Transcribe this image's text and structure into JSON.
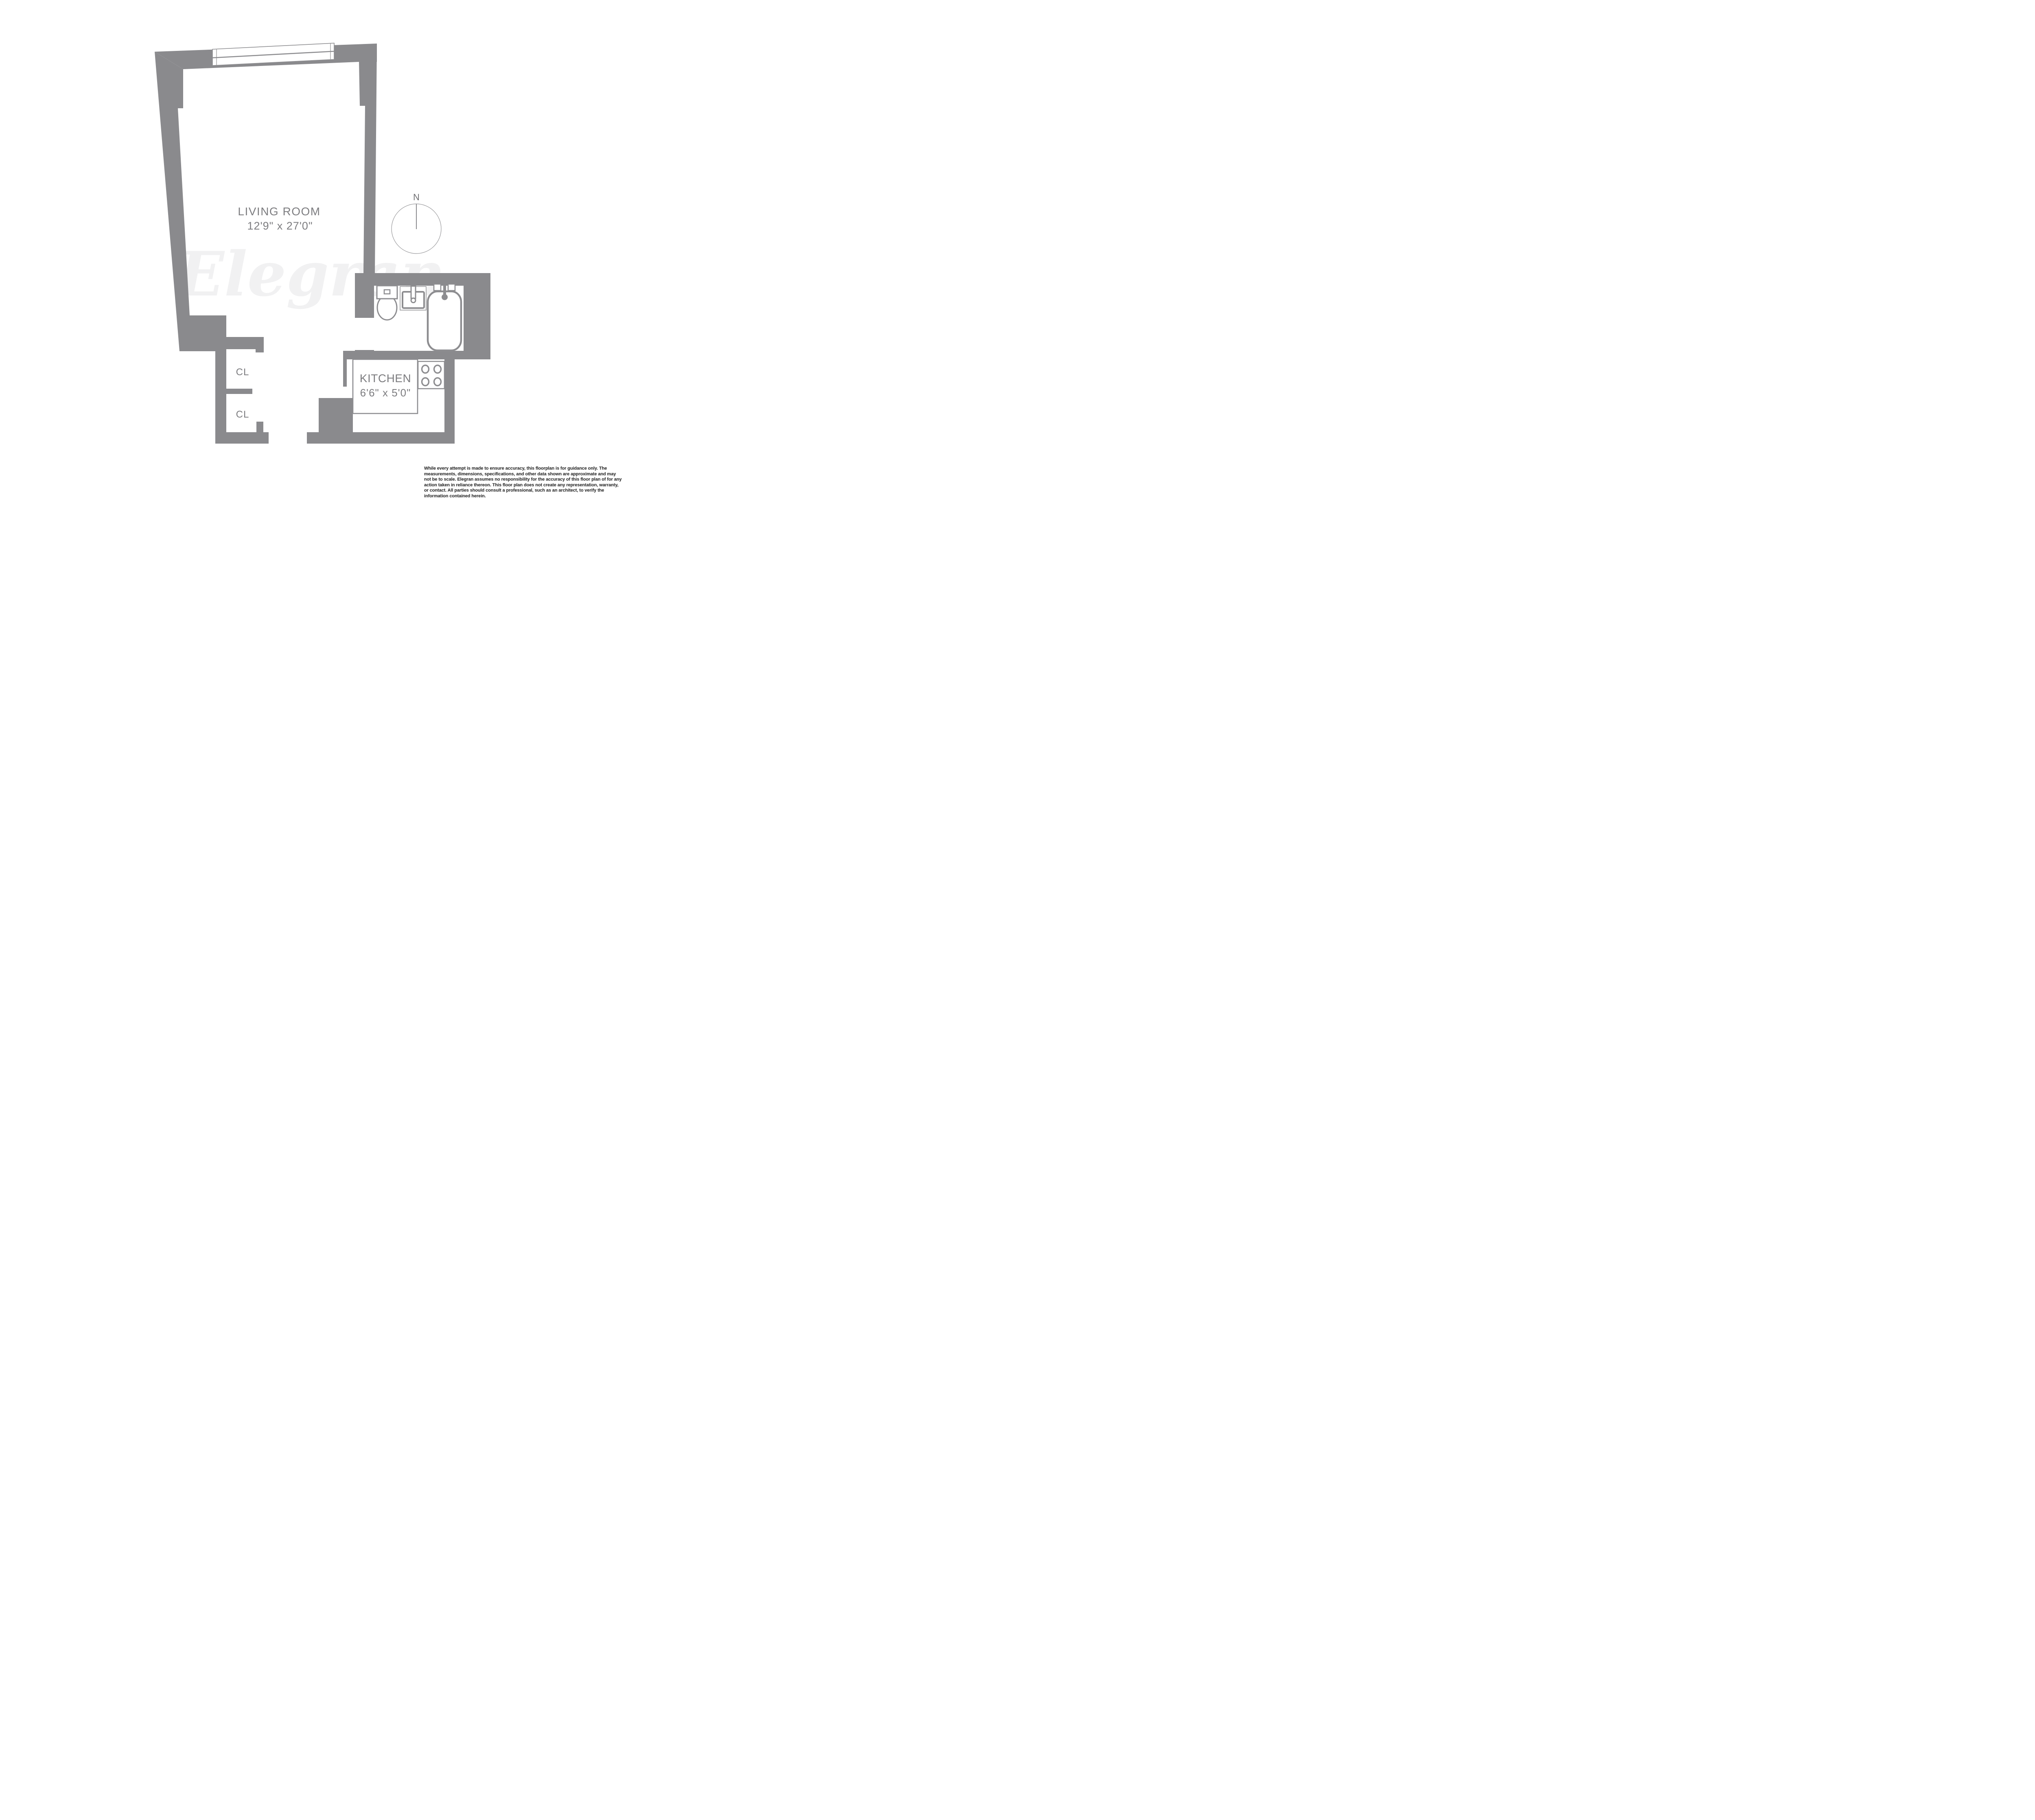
{
  "floorplan": {
    "watermark": "Elegran",
    "compass": {
      "north_label": "N"
    },
    "rooms": {
      "living_room": {
        "label": "LIVING ROOM",
        "dims": "12'9\" x 27'0\""
      },
      "kitchen": {
        "label": "KITCHEN",
        "dims": "6'6\" x 5'0\""
      },
      "closet_upper": {
        "label": "CL"
      },
      "closet_lower": {
        "label": "CL"
      }
    },
    "fixtures": [
      "window",
      "toilet",
      "sink",
      "bathtub",
      "stove"
    ],
    "colors": {
      "wall": "#8a8a8d",
      "fixture_stroke": "#8d8d90",
      "room_label": "#7d7d80",
      "watermark": "#f1f1f2",
      "disclaimer_text": "#1b1b1b",
      "background": "#ffffff"
    },
    "disclaimer": "While every attempt is made to ensure accuracy, this floorplan is for guidance only. The measurements, dimensions, specifications, and other data shown are approximate and may not be to scale. Elegran assumes no responsibility for the accuracy of this floor plan of for any action taken in reliance thereon. This floor plan does not create any representation, warranty, or contact. All parties should consult a professional, such as an architect, to verify the information contained herein."
  }
}
